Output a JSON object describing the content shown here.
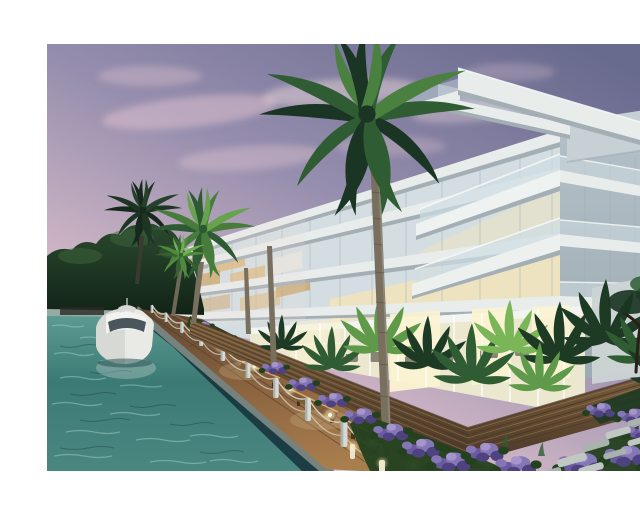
{
  "meta": {
    "title": "Waterfront condominium architectural rendering",
    "description": "Dusk rendering of a modern white glass condominium on a turquoise canal with a docked white motor yacht, timber boardwalk with rope bollard railing, benches and path lights, purple flower beds, tropical ferns, stepping stones and tall palm trees under a pink-purple sky.",
    "media_type": "architectural-rendering-photo",
    "border": "white frame around image"
  },
  "scene": {
    "objects": [
      {
        "name": "sky",
        "label": "dusk sky with pink clouds"
      },
      {
        "name": "building",
        "label": "modern white condominium with glass balconies and lit interiors"
      },
      {
        "name": "palm-trees",
        "label": "tall royal palms in front of facade"
      },
      {
        "name": "treeline",
        "label": "dark tree line on far canal bank"
      },
      {
        "name": "canal",
        "label": "turquoise canal water"
      },
      {
        "name": "yacht",
        "label": "white motor yacht moored at seawall"
      },
      {
        "name": "boardwalk",
        "label": "timber boardwalk with rope bollard railing"
      },
      {
        "name": "benches",
        "label": "wooden benches with under-lighting"
      },
      {
        "name": "planters",
        "label": "timber slat planter walls with ferns"
      },
      {
        "name": "flowers",
        "label": "purple flowering shrubs"
      },
      {
        "name": "stepping-stones",
        "label": "stone paver path"
      },
      {
        "name": "right-tree",
        "label": "dark tree silhouette at right edge"
      }
    ]
  },
  "colors": {
    "frame": "#ffffff",
    "skyTop": "#686a8e",
    "skyMid": "#968eae",
    "skyPink": "#cdb4c4",
    "skyHorizon": "#eedad9",
    "cloud1": "#dcc0cc",
    "cloud2": "#e9d3d8",
    "slabWhite": "#e8edec",
    "slabUnder": "#a3afb4",
    "glassPale": "#d4dee2",
    "glassBlue": "#c7d6dc",
    "bldgShade": "#b5c1c8",
    "bldgShadeDark": "#9caab2",
    "boxTop": "#c6d0d5",
    "boxSide": "#b1bdc3",
    "pillar": "#c9d3d7",
    "railGlass": "#cfdde2",
    "mullion": "#96a7ae",
    "warmGlass": "#efe3bd",
    "warmGlow": "#fbf3d2",
    "amber1": "#c79d58",
    "amber2": "#dcb56e",
    "whiteBalcony": "#e8e8e2",
    "groundGlass": "#ece7cf",
    "ceiling": "#f2f4f0",
    "furniture": "#6e6a5c",
    "wallLight": "#ccd4d4",
    "treeTop": "#2a4a2e",
    "treeDeep": "#122317",
    "treeHi": "#3e6339",
    "palmDark": "#1b3524",
    "palmMid": "#2f5c33",
    "palmLight": "#4a8040",
    "palmBright": "#67a24e",
    "trunk": "#786f5e",
    "trunkShade": "#5c554a",
    "trunkHi": "#97907e",
    "waterHi": "#9ed0c4",
    "waterMid": "#5f9d95",
    "waterDeep": "#3c7a75",
    "waterFore": "#4b8781",
    "waterShadow": "#14303a",
    "waterGlint": "#c8e4da",
    "wood": "#8a6340",
    "woodLight": "#a97e4e",
    "woodDark": "#503a26",
    "deckDark": "#5e4630",
    "deckHi": "#c1955e",
    "slat": "#7c5f3e",
    "slatDark": "#4a3827",
    "slatLight": "#a07c4e",
    "bollard": "#d6dbd6",
    "bollardShade": "#98a19b",
    "rope": "#d8d4c4",
    "lightGlow": "#ffedb8",
    "lightCore": "#fff6d8",
    "bench": "#7d5c3a",
    "benchLit": "#d9a866",
    "benchLeg": "#46341f",
    "flower1": "#8576b5",
    "flower2": "#6a5a9e",
    "flower3": "#4e4280",
    "flower4": "#a695cc",
    "bedGreen": "#23401f",
    "fernDark": "#1d3a24",
    "fernLight": "#5f9a4a",
    "fernBright": "#7ab558",
    "stone": "#bfc8c3",
    "stoneDark": "#a8b3ac",
    "boatHull": "#e9eae6",
    "boatShadow": "#c2c6c2",
    "boatGlass": "#39454b",
    "boatTrim": "#d8d8d4",
    "branch": "#2a2018"
  }
}
